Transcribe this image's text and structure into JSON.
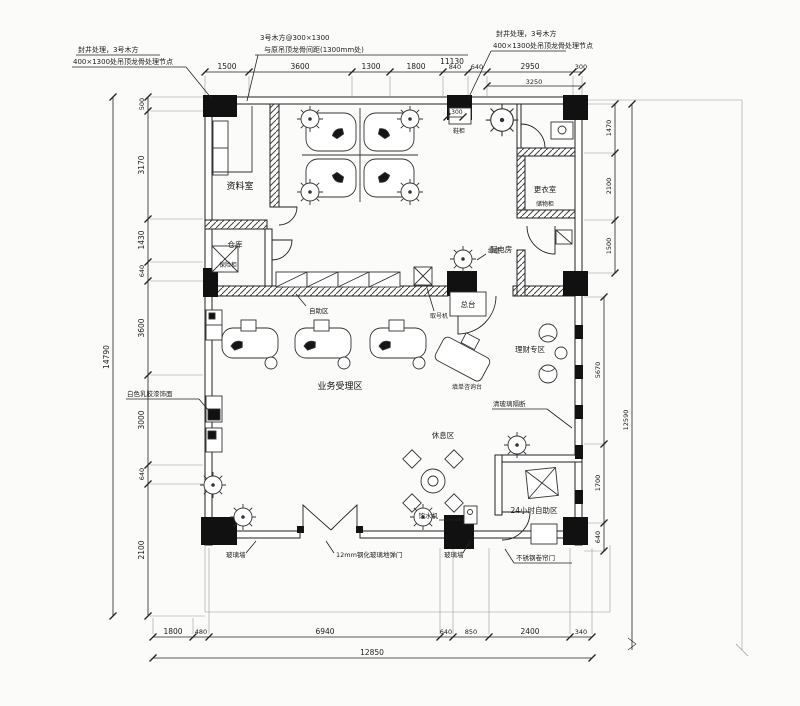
{
  "drawing_type": "floor-plan",
  "notes": {
    "tl1": "封井处理，3号木方",
    "tl2": "400×1300处吊顶龙骨处理节点",
    "tc1": "3号木方@300×1300",
    "tc2": "与原吊顶龙骨间距(1300mm处)",
    "tr1": "封井处理，3号木方",
    "tr2": "400×1300处吊顶龙骨处理节点",
    "left_wall": "白色乳胶漆饰面",
    "glass_partition": "清玻璃隔断",
    "glass_wall_left": "玻璃墙",
    "entrance_door": "12mm钢化玻璃地弹门",
    "glass_wall_right": "玻璃墙",
    "rolling_door": "不锈钢卷帘门",
    "waiting": "自助区",
    "queue_machine": "取号机",
    "plant": "绿植",
    "water": "饮水机"
  },
  "rooms": {
    "archive": "资料室",
    "storage": "仓库",
    "safe": "保险柜",
    "changing": "更衣室",
    "locker": "储物柜",
    "power": "配电房",
    "reception": "总台",
    "business": "业务受理区",
    "wealth": "理财专区",
    "form_desk": "填单咨询台",
    "rest": "休息区",
    "self_service": "24小时自助区",
    "shoe": "鞋柜"
  },
  "dims": {
    "top": [
      "1500",
      "3600",
      "1300",
      "1800",
      "840",
      "640",
      "2950",
      "300"
    ],
    "top_sub": "3250",
    "top_overall": "11130",
    "left": [
      "500",
      "3170",
      "1430",
      "640",
      "3600",
      "3000",
      "640",
      "2100"
    ],
    "left_overall": "14790",
    "right_upper": [
      "1470",
      "2100",
      "1500"
    ],
    "right_lower": [
      "5670",
      "1700",
      "640"
    ],
    "right_overall": "12590",
    "bottom": [
      "1800",
      "480",
      "6940",
      "640",
      "850",
      "2400",
      "340"
    ],
    "bottom_overall": "12850",
    "vestibule": "1300"
  }
}
